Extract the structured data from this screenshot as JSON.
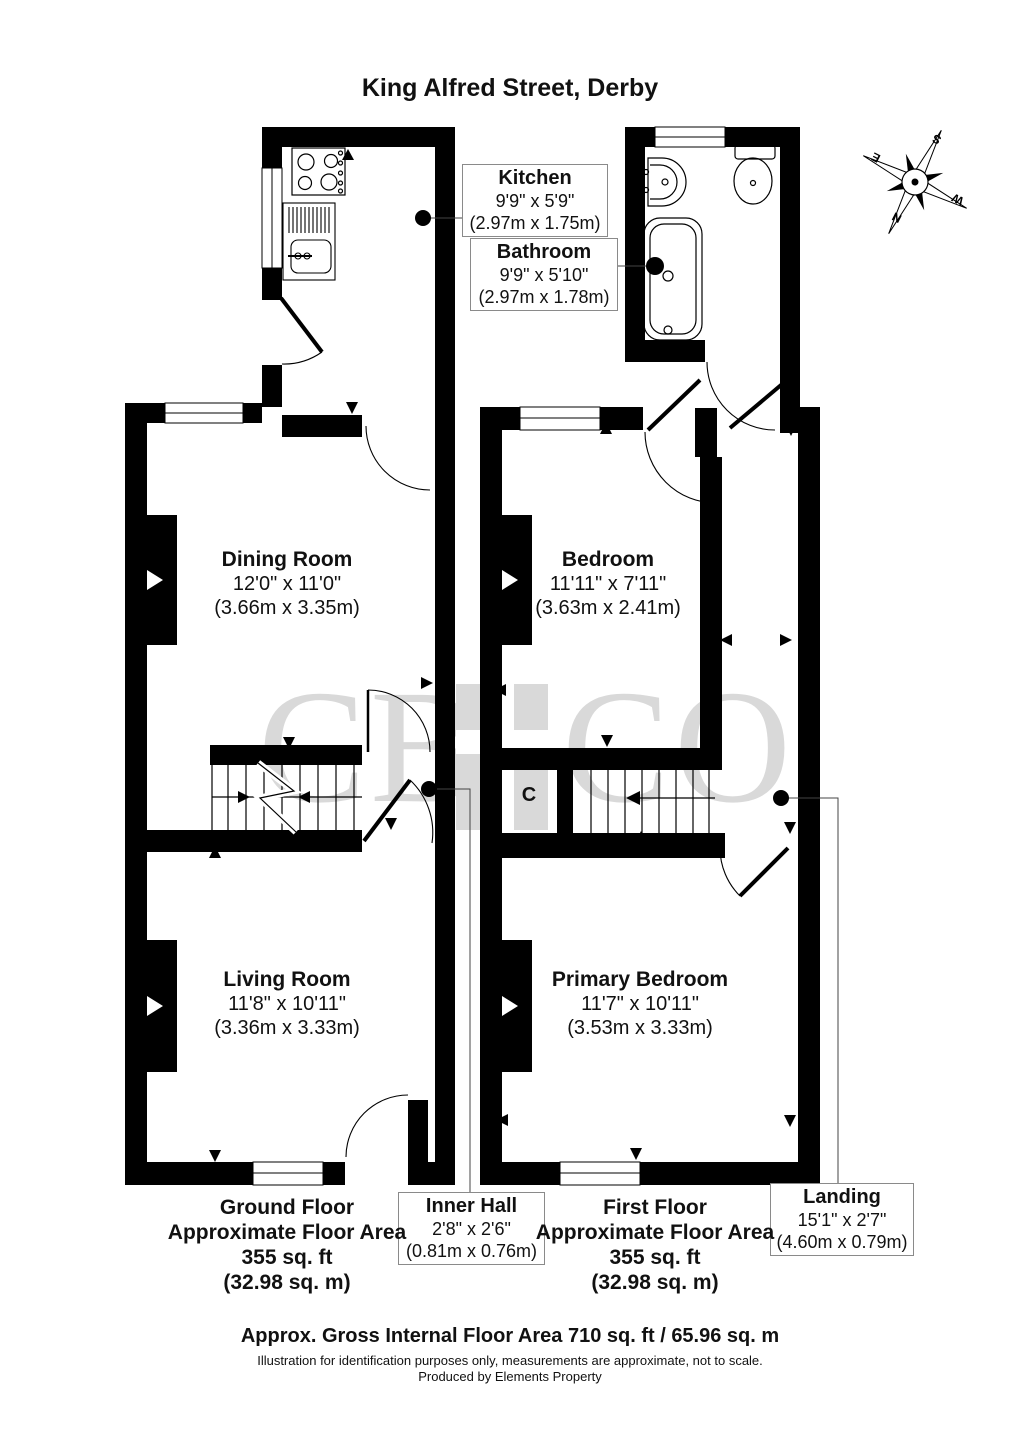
{
  "title": "King Alfred Street, Derby",
  "watermark": {
    "left": "CB",
    "right": "CO"
  },
  "compass": {
    "n": "N",
    "s": "S",
    "e": "E",
    "w": "W"
  },
  "rooms": {
    "kitchen": {
      "name": "Kitchen",
      "imperial": "9'9\" x 5'9\"",
      "metric": "(2.97m x 1.75m)"
    },
    "bathroom": {
      "name": "Bathroom",
      "imperial": "9'9\" x 5'10\"",
      "metric": "(2.97m x 1.78m)"
    },
    "dining": {
      "name": "Dining Room",
      "imperial": "12'0\" x 11'0\"",
      "metric": "(3.66m x 3.35m)"
    },
    "bedroom": {
      "name": "Bedroom",
      "imperial": "11'11\" x 7'11\"",
      "metric": "(3.63m x 2.41m)"
    },
    "living": {
      "name": "Living Room",
      "imperial": "11'8\" x 10'11\"",
      "metric": "(3.36m x 3.33m)"
    },
    "primary": {
      "name": "Primary Bedroom",
      "imperial": "11'7\" x 10'11\"",
      "metric": "(3.53m x 3.33m)"
    },
    "inner_hall": {
      "name": "Inner Hall",
      "imperial": "2'8\" x 2'6\"",
      "metric": "(0.81m x 0.76m)"
    },
    "landing": {
      "name": "Landing",
      "imperial": "15'1\" x 2'7\"",
      "metric": "(4.60m x 0.79m)"
    },
    "cupboard": {
      "label": "C"
    }
  },
  "areas": {
    "ground": {
      "line1": "Ground Floor",
      "line2": "Approximate Floor Area",
      "line3": "355 sq. ft",
      "line4": "(32.98 sq. m)"
    },
    "first": {
      "line1": "First Floor",
      "line2": "Approximate Floor Area",
      "line3": "355 sq. ft",
      "line4": "(32.98 sq. m)"
    }
  },
  "footer": {
    "total": "Approx. Gross Internal Floor Area 710 sq. ft / 65.96 sq. m",
    "disclaimer": "Illustration for identification purposes only, measurements are approximate, not to scale.",
    "producer": "Produced by Elements Property"
  },
  "colors": {
    "wall": "#000000",
    "watermark": "#d9d9d9"
  }
}
